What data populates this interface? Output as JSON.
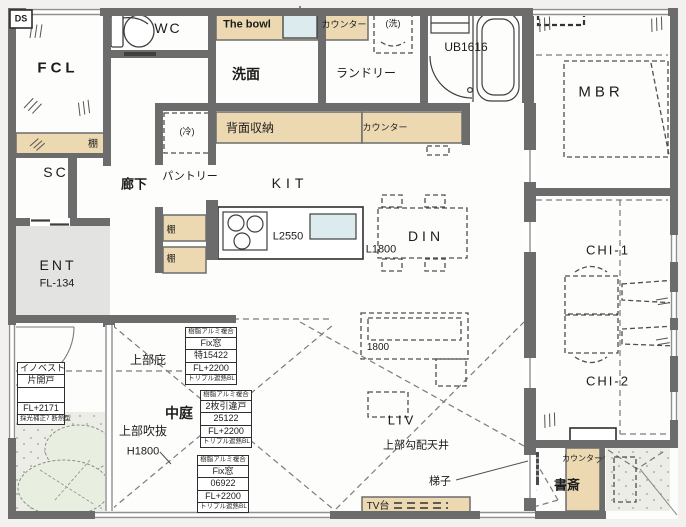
{
  "plan_title": "1F floor plan",
  "labels": {
    "ds": "DS",
    "fcl": "FCL",
    "wc": "WC",
    "the_bowl": "The bowl",
    "senmen": "洗面",
    "counter": "カウンター",
    "washer": "(洗)",
    "laundry": "ランドリー",
    "ub": "UB1616",
    "mbr": "MBR",
    "shelf": "棚",
    "sc": "SC",
    "hallway": "廊下",
    "pantry": "パントリー",
    "fridge": "(冷)",
    "back_storage": "背面収納",
    "kit": "KIT",
    "l2550": "L2550",
    "l1800": "L1800",
    "din": "DIN",
    "ent": "ENT",
    "ent_level": "FL-134",
    "eave": "上部庇",
    "courtyard": "中庭",
    "upper_void": "上部吹抜",
    "void_height": "H1800",
    "sofa_width": "1800",
    "liv": "LIV",
    "sloped_ceiling": "上部勾配天井",
    "tv_stand": "TV台",
    "ladder": "梯子",
    "study": "書斎",
    "chi1": "CHI-1",
    "chi2": "CHI-2"
  },
  "door_tag": {
    "lines": [
      "イノベスト",
      "片開戸",
      "FL+2171",
      "採光補正7 断熱型"
    ]
  },
  "window_tags": [
    {
      "lines": [
        "樹脂アルミ複合",
        "Fix窓",
        "特15422",
        "FL+2200",
        "トリプル遮熱BL"
      ]
    },
    {
      "lines": [
        "樹脂アルミ複合",
        "2枚引違戸",
        "25122",
        "FL+2200",
        "トリプル遮熱BL"
      ]
    },
    {
      "lines": [
        "樹脂アルミ複合",
        "Fix窓",
        "06922",
        "FL+2200",
        "トリプル遮熱BL"
      ]
    }
  ],
  "colors": {
    "wall": "#6c6c6c",
    "counter_fill": "#ecd9b2",
    "sink_fill": "#dcecee",
    "entry_floor": "#e3e3e1",
    "stipple_floor": "#ecede7",
    "tree_fill": "#e8eee0",
    "dash_line": "#7b7b7b"
  }
}
